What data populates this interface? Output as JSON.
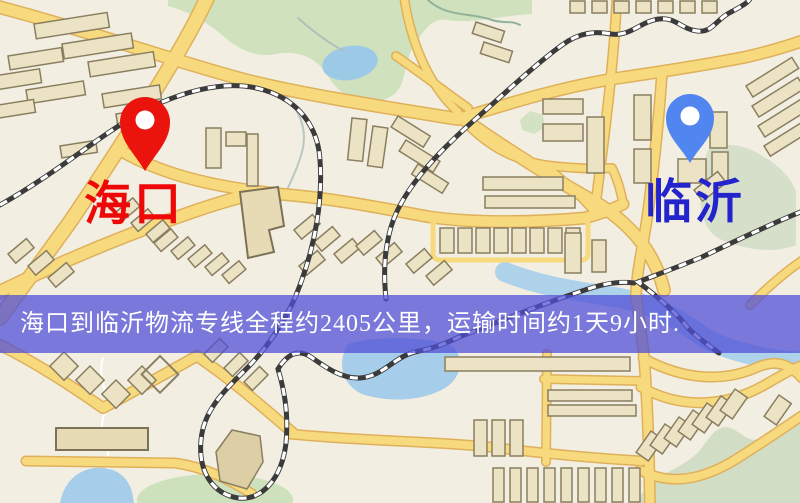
{
  "meta": {
    "type": "logistics-route-map"
  },
  "banner": {
    "text": "海口到临沂物流专线全程约2405公里，运输时间约1天9小时."
  },
  "origin": {
    "label": "海口",
    "pin_color": "#ea140c",
    "label_color": "#ee0808"
  },
  "destination": {
    "label": "临沂",
    "pin_color": "#5186f0",
    "label_color": "#2424cc"
  },
  "map_colors": {
    "background": "#f2eee2",
    "road": "#f8da7e",
    "road_casing": "#dfb05a",
    "park": "#cfe1bd",
    "water": "#a6cde9",
    "railway": "#3b3b3b",
    "building": "#ece2c4",
    "building_outline": "#8a7e60",
    "banner_background": "rgba(80,78,214,0.74)"
  }
}
